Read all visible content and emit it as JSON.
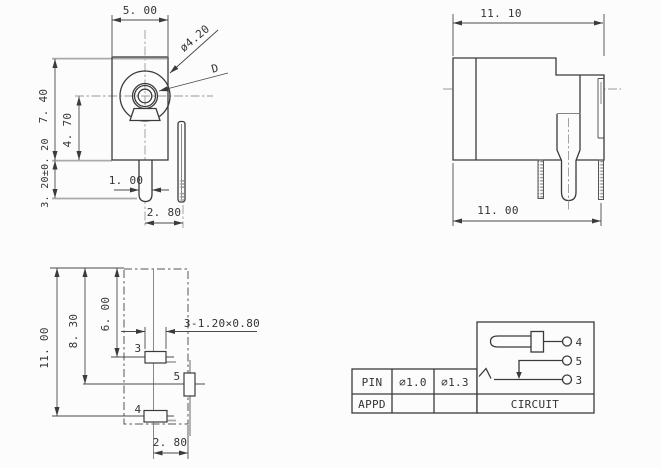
{
  "drawing": {
    "front_view": {
      "width": "5. 00",
      "body_height": "7. 40",
      "center_height": "4. 70",
      "pin_protrusion": "3. 20±0. 20",
      "pin_width": "1. 00",
      "pin_offset": "2. 80",
      "barrel_dia": "ø4.20",
      "center_pin_dia": "D"
    },
    "side_view": {
      "overall_width": "11. 10",
      "body_width": "11. 00"
    },
    "bottom_view": {
      "length": "11. 00",
      "pin5_pos": "8. 30",
      "pin3_pos": "6. 00",
      "slot_spec": "3-1.20×0.80",
      "pin5_offset": "2. 80",
      "pad3_label": "3",
      "pad5_label": "5",
      "pad4_label": "4"
    },
    "table": {
      "col1_header": "PIN",
      "col2": "∅1.0",
      "col3": "∅1.3",
      "row2_label": "APPD",
      "circuit_label": "CIRCUIT"
    },
    "circuit": {
      "pin4": "4",
      "pin5": "5",
      "pin3": "3"
    },
    "colors": {
      "background": "#fcfcfc",
      "line": "#3b3b3b",
      "centerline": "#999999",
      "text": "#333333"
    }
  }
}
